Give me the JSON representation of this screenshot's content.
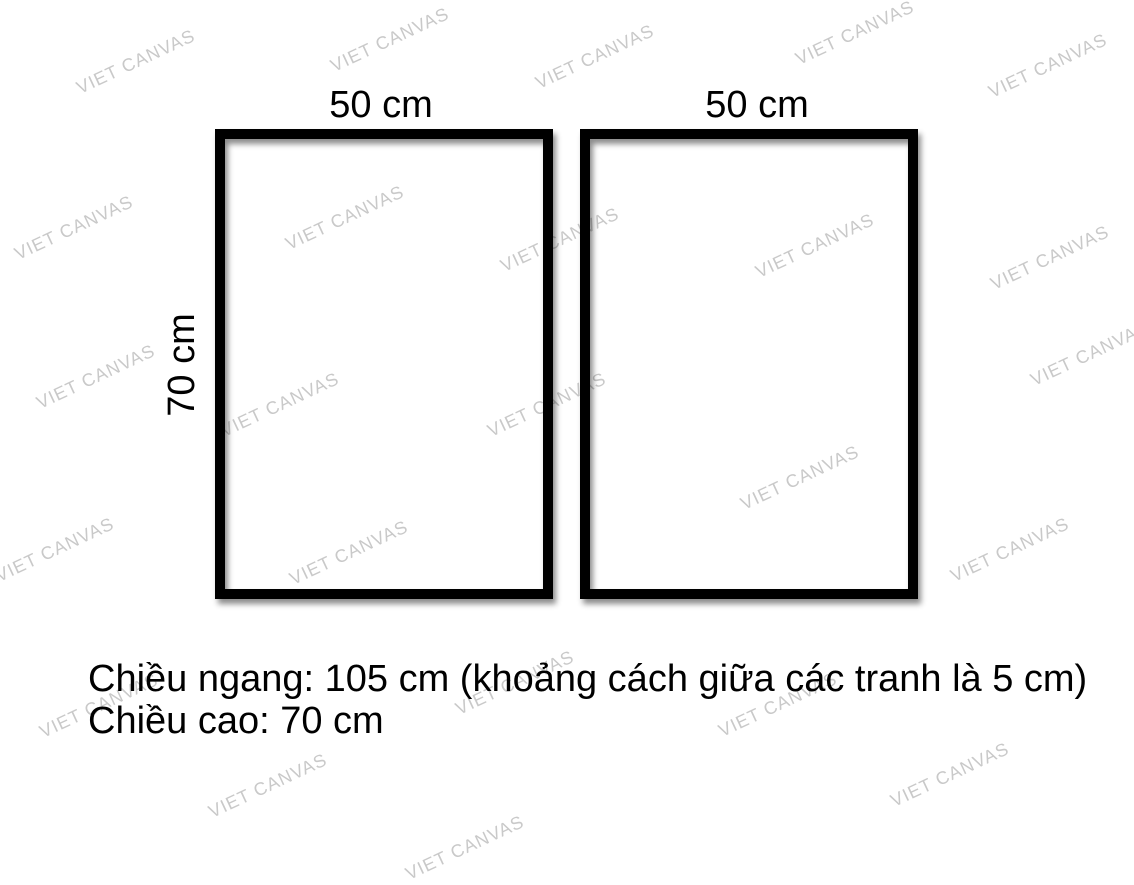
{
  "watermark": {
    "text": "VIET CANVAS",
    "color": "#c9c9c9",
    "positions": [
      [
        136,
        62
      ],
      [
        390,
        40
      ],
      [
        595,
        57
      ],
      [
        855,
        33
      ],
      [
        1048,
        66
      ],
      [
        74,
        228
      ],
      [
        345,
        218
      ],
      [
        560,
        240
      ],
      [
        815,
        246
      ],
      [
        1050,
        258
      ],
      [
        96,
        377
      ],
      [
        280,
        405
      ],
      [
        547,
        405
      ],
      [
        1090,
        354
      ],
      [
        55,
        550
      ],
      [
        349,
        553
      ],
      [
        800,
        478
      ],
      [
        1010,
        550
      ],
      [
        99,
        706
      ],
      [
        268,
        786
      ],
      [
        515,
        683
      ],
      [
        778,
        705
      ],
      [
        950,
        775
      ],
      [
        465,
        848
      ]
    ]
  },
  "frames": [
    {
      "width_label": "50 cm"
    },
    {
      "width_label": "50 cm"
    }
  ],
  "height_label": "70 cm",
  "caption": {
    "line1": "Chiều ngang: 105 cm (khoảng cách giữa các tranh là 5 cm)",
    "line2": "Chiều cao: 70 cm"
  }
}
